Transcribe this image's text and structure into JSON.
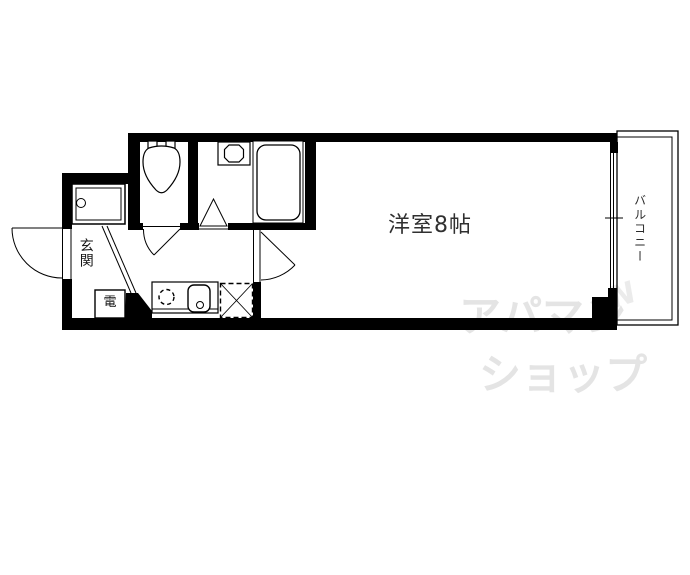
{
  "floorplan": {
    "main_room": {
      "label": "洋室8帖"
    },
    "entrance": {
      "label": "玄関"
    },
    "balcony": {
      "label": "バルコニー"
    },
    "water_heater": {
      "label": "電"
    },
    "watermark": {
      "line1": "アパマン",
      "line2": "ショップ",
      "mark": "N"
    },
    "fixture_icons": [
      "toilet-icon",
      "bathtub-icon",
      "washbasin-icon",
      "washing-machine-pan-icon",
      "stove-burner-icon",
      "kitchen-sink-icon",
      "refrigerator-space-icon"
    ],
    "colors": {
      "wall": "#000000",
      "label_text": "#2f2f2f",
      "watermark": "#e4e4e4",
      "background": "#ffffff"
    }
  }
}
